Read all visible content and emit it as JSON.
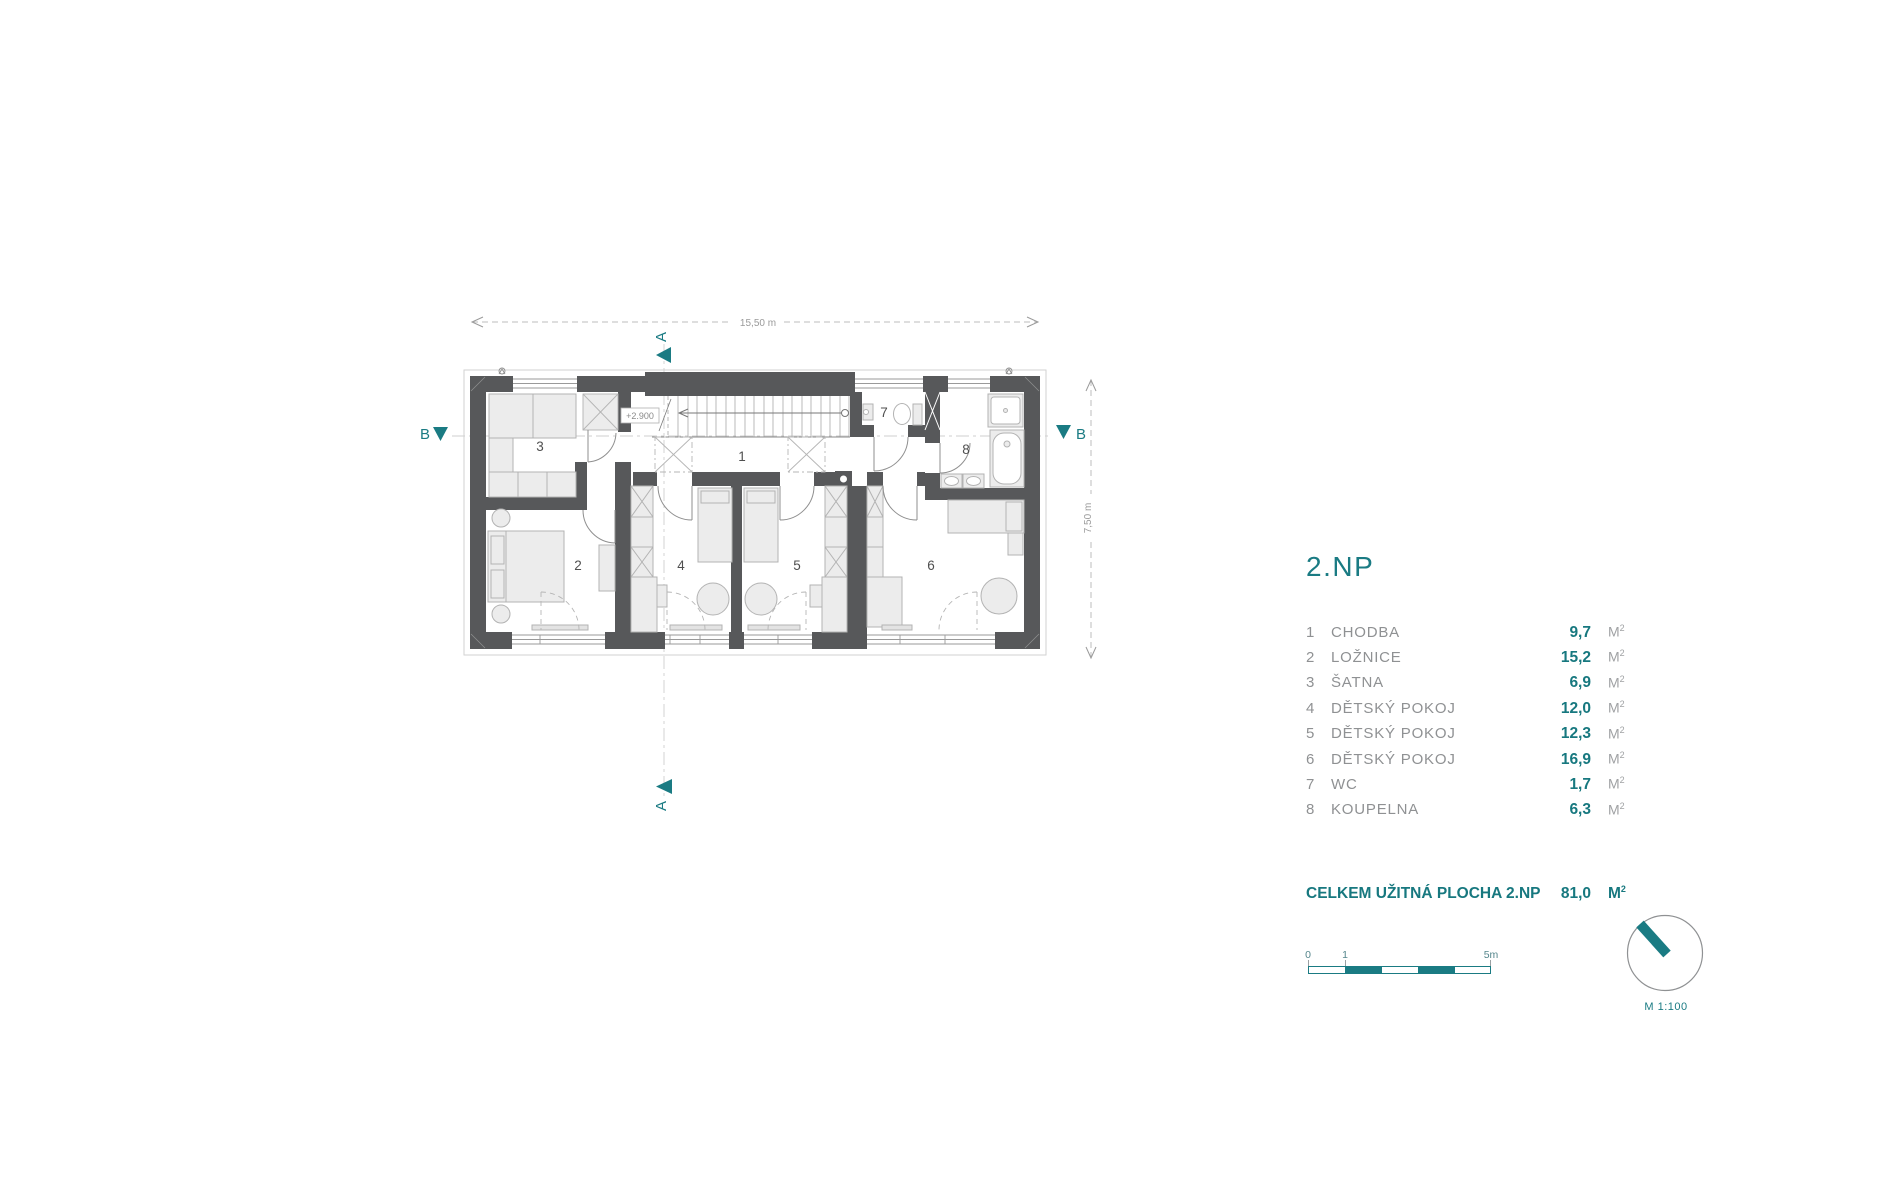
{
  "colors": {
    "accent": "#1a7b83",
    "wall": "#57585a"
  },
  "plan": {
    "rooms": [
      "1",
      "2",
      "3",
      "4",
      "5",
      "6",
      "7",
      "8"
    ],
    "level_marker": "+2.900",
    "dim_width": "15,50 m",
    "dim_height": "7,50 m",
    "section_a": "A",
    "section_b": "B"
  },
  "legend": {
    "title": "2.NP",
    "items": [
      {
        "no": "1",
        "label": "CHODBA",
        "area": "9,7"
      },
      {
        "no": "2",
        "label": "LOŽNICE",
        "area": "15,2"
      },
      {
        "no": "3",
        "label": "ŠATNA",
        "area": "6,9"
      },
      {
        "no": "4",
        "label": "DĚTSKÝ POKOJ",
        "area": "12,0"
      },
      {
        "no": "5",
        "label": "DĚTSKÝ POKOJ",
        "area": "12,3"
      },
      {
        "no": "6",
        "label": "DĚTSKÝ POKOJ",
        "area": "16,9"
      },
      {
        "no": "7",
        "label": "WC",
        "area": "1,7"
      },
      {
        "no": "8",
        "label": "KOUPELNA",
        "area": "6,3"
      }
    ],
    "unit": "M",
    "unit_sup": "2",
    "total_label": "CELKEM UŽITNÁ PLOCHA 2.NP",
    "total_value": "81,0"
  },
  "scalebar": {
    "tick0": "0",
    "tick1": "1",
    "tick5": "5m"
  },
  "north_label": "M 1:100"
}
